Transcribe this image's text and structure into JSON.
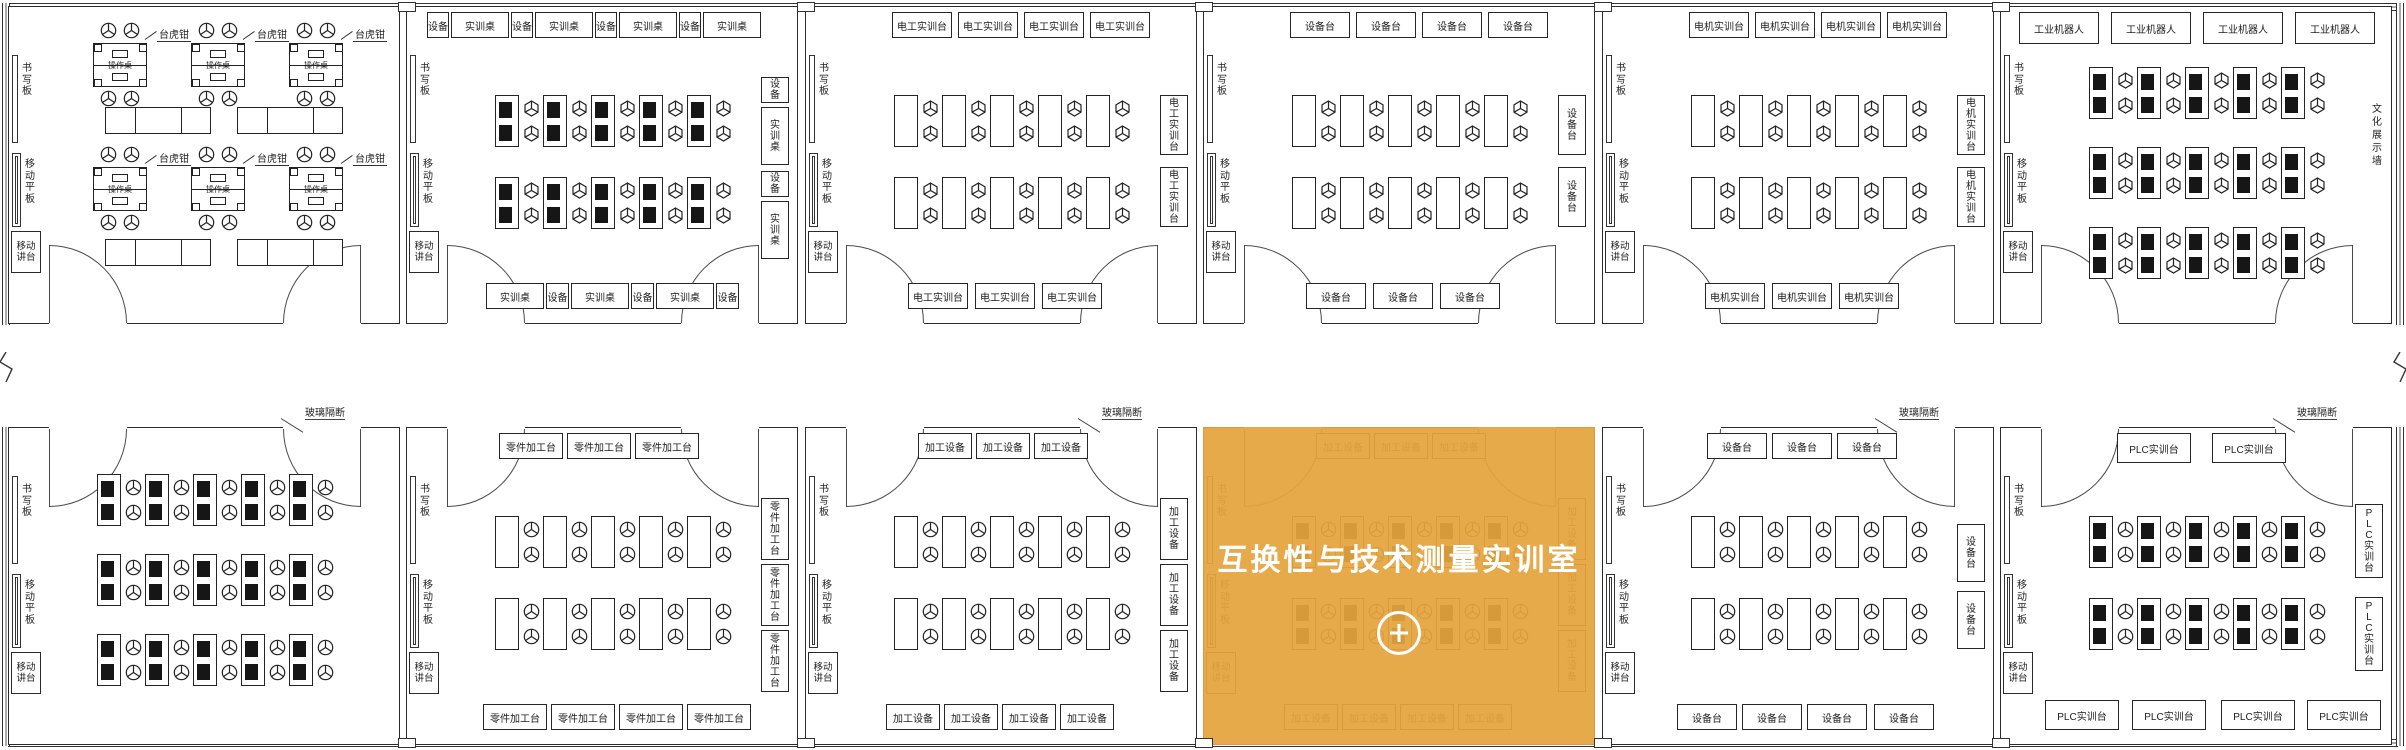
{
  "canvas": {
    "width": 2406,
    "height": 750
  },
  "palette": {
    "line": "#2b2b2b",
    "background": "#ffffff",
    "highlight_orange": "#e5a43e",
    "highlight_text": "#ffffff"
  },
  "highlight": {
    "title": "互换性与技术测量实训室",
    "icon": "plus-circle-icon",
    "room": "b4"
  },
  "shared_labels": {
    "writing_board": "书写板",
    "mobile_panel": "移动平板",
    "mobile_podium": "移动\n讲台",
    "glass_partition": "玻璃隔断",
    "culture_wall": "文化展示墙"
  },
  "rooms": [
    {
      "id": "t1",
      "name": "fitter-vise-room",
      "row": 0,
      "col": 0,
      "kind": "vise",
      "left_items": {
        "board": "书写板",
        "panel": "移动平板",
        "podium": "移动\n讲台"
      },
      "vise": {
        "callout": "台虎钳",
        "bench": "操作桌",
        "groups": 6,
        "cabinets": 4
      }
    },
    {
      "id": "t2",
      "name": "training-desk-room",
      "row": 0,
      "col": 1,
      "kind": "desks",
      "left_items": {
        "board": "书写板",
        "panel": "移动平板",
        "podium": "移动\n讲台"
      },
      "desks": {
        "rows": 2,
        "cols": 5,
        "style": "computer",
        "chair": "cube"
      },
      "top_boxes": [
        {
          "text": "设备",
          "x": 20,
          "w": 22
        },
        {
          "text": "实训桌",
          "x": 44,
          "w": 58
        },
        {
          "text": "设备",
          "x": 104,
          "w": 22
        },
        {
          "text": "实训桌",
          "x": 128,
          "w": 58
        },
        {
          "text": "设备",
          "x": 188,
          "w": 22
        },
        {
          "text": "实训桌",
          "x": 212,
          "w": 58
        },
        {
          "text": "设备",
          "x": 272,
          "w": 22
        },
        {
          "text": "实训桌",
          "x": 296,
          "w": 58
        }
      ],
      "bottom_boxes": [
        {
          "text": "实训桌",
          "x": 79,
          "w": 58
        },
        {
          "text": "设备",
          "x": 139,
          "w": 23
        },
        {
          "text": "实训桌",
          "x": 164,
          "w": 58
        },
        {
          "text": "设备",
          "x": 224,
          "w": 23
        },
        {
          "text": "实训桌",
          "x": 249,
          "w": 58
        },
        {
          "text": "设备",
          "x": 309,
          "w": 23
        }
      ],
      "right_boxes": [
        {
          "text": "设备",
          "y": 70,
          "h": 26
        },
        {
          "text": "实训桌",
          "y": 100,
          "h": 58
        },
        {
          "text": "设备",
          "y": 164,
          "h": 26
        },
        {
          "text": "实训桌",
          "y": 194,
          "h": 58
        }
      ]
    },
    {
      "id": "t3",
      "name": "electrician-training-room",
      "row": 0,
      "col": 2,
      "kind": "desks",
      "left_items": {
        "board": "书写板",
        "panel": "移动平板",
        "podium": "移动\n讲台"
      },
      "desks": {
        "rows": 2,
        "cols": 5,
        "style": "plain",
        "chair": "cube"
      },
      "top_boxes": [
        {
          "text": "电工实训台",
          "x": 86,
          "w": 60
        },
        {
          "text": "电工实训台",
          "x": 152,
          "w": 60
        },
        {
          "text": "电工实训台",
          "x": 218,
          "w": 60
        },
        {
          "text": "电工实训台",
          "x": 284,
          "w": 60
        }
      ],
      "bottom_boxes": [
        {
          "text": "电工实训台",
          "x": 102,
          "w": 60
        },
        {
          "text": "电工实训台",
          "x": 169,
          "w": 60
        },
        {
          "text": "电工实训台",
          "x": 236,
          "w": 60
        }
      ],
      "right_boxes": [
        {
          "text": "电工实训台",
          "y": 88,
          "h": 60
        },
        {
          "text": "电工实训台",
          "y": 160,
          "h": 60
        }
      ]
    },
    {
      "id": "t4",
      "name": "equipment-table-room-top",
      "row": 0,
      "col": 3,
      "kind": "desks",
      "left_items": {
        "board": "书写板",
        "panel": "移动平板",
        "podium": "移动\n讲台"
      },
      "desks": {
        "rows": 2,
        "cols": 5,
        "style": "plain",
        "chair": "cube"
      },
      "top_boxes": [
        {
          "text": "设备台",
          "x": 86,
          "w": 60
        },
        {
          "text": "设备台",
          "x": 152,
          "w": 60
        },
        {
          "text": "设备台",
          "x": 218,
          "w": 60
        },
        {
          "text": "设备台",
          "x": 284,
          "w": 60
        }
      ],
      "bottom_boxes": [
        {
          "text": "设备台",
          "x": 102,
          "w": 60
        },
        {
          "text": "设备台",
          "x": 169,
          "w": 60
        },
        {
          "text": "设备台",
          "x": 236,
          "w": 60
        }
      ],
      "right_boxes": [
        {
          "text": "设备台",
          "y": 88,
          "h": 60
        },
        {
          "text": "设备台",
          "y": 160,
          "h": 60
        }
      ]
    },
    {
      "id": "t5",
      "name": "motor-training-room",
      "row": 0,
      "col": 4,
      "kind": "desks",
      "left_items": {
        "board": "书写板",
        "panel": "移动平板",
        "podium": "移动\n讲台"
      },
      "desks": {
        "rows": 2,
        "cols": 5,
        "style": "plain",
        "chair": "cube"
      },
      "top_boxes": [
        {
          "text": "电机实训台",
          "x": 86,
          "w": 60
        },
        {
          "text": "电机实训台",
          "x": 152,
          "w": 60
        },
        {
          "text": "电机实训台",
          "x": 218,
          "w": 60
        },
        {
          "text": "电机实训台",
          "x": 284,
          "w": 60
        }
      ],
      "bottom_boxes": [
        {
          "text": "电机实训台",
          "x": 102,
          "w": 60
        },
        {
          "text": "电机实训台",
          "x": 169,
          "w": 60
        },
        {
          "text": "电机实训台",
          "x": 236,
          "w": 60
        }
      ],
      "right_boxes": [
        {
          "text": "电机实训台",
          "y": 88,
          "h": 60
        },
        {
          "text": "电机实训台",
          "y": 160,
          "h": 60
        }
      ]
    },
    {
      "id": "t6",
      "name": "industrial-robot-room",
      "row": 0,
      "col": 5,
      "kind": "desks",
      "left_items": {
        "board": "书写板",
        "panel": "移动平板",
        "podium": "移动\n讲台"
      },
      "desks": {
        "rows": 3,
        "cols": 5,
        "style": "computer",
        "chair": "cube"
      },
      "top_boxes": [
        {
          "text": "工业机器人",
          "x": 18,
          "w": 80,
          "h": 32
        },
        {
          "text": "工业机器人",
          "x": 110,
          "w": 80,
          "h": 32
        },
        {
          "text": "工业机器人",
          "x": 202,
          "w": 80,
          "h": 32
        },
        {
          "text": "工业机器人",
          "x": 294,
          "w": 80,
          "h": 32
        }
      ],
      "right_wall_label": "文化展示墙"
    },
    {
      "id": "b1",
      "name": "computer-training-room",
      "row": 1,
      "col": 0,
      "kind": "desks",
      "left_items": {
        "board": "书写板",
        "panel": "移动平板",
        "podium": "移动\n讲台"
      },
      "desks": {
        "rows": 3,
        "cols": 5,
        "style": "computer",
        "chair": "fan"
      },
      "glass_partition": "玻璃隔断"
    },
    {
      "id": "b2",
      "name": "parts-machining-room",
      "row": 1,
      "col": 1,
      "kind": "desks",
      "left_items": {
        "board": "书写板",
        "panel": "移动平板",
        "podium": "移动\n讲台"
      },
      "desks": {
        "rows": 2,
        "cols": 5,
        "style": "plain",
        "chair": "fan"
      },
      "top_boxes": [
        {
          "text": "零件加工台",
          "x": 92,
          "w": 64
        },
        {
          "text": "零件加工台",
          "x": 160,
          "w": 64
        },
        {
          "text": "零件加工台",
          "x": 228,
          "w": 64
        }
      ],
      "bottom_boxes": [
        {
          "text": "零件加工台",
          "x": 76,
          "w": 64
        },
        {
          "text": "零件加工台",
          "x": 144,
          "w": 64
        },
        {
          "text": "零件加工台",
          "x": 212,
          "w": 64
        },
        {
          "text": "零件加工台",
          "x": 280,
          "w": 64
        }
      ],
      "right_boxes": [
        {
          "text": "零件加工台",
          "y": 70,
          "h": 62
        },
        {
          "text": "零件加工台",
          "y": 136,
          "h": 62
        },
        {
          "text": "零件加工台",
          "y": 202,
          "h": 62
        }
      ]
    },
    {
      "id": "b3",
      "name": "machining-equipment-room",
      "row": 1,
      "col": 2,
      "kind": "desks",
      "left_items": {
        "board": "书写板",
        "panel": "移动平板",
        "podium": "移动\n讲台"
      },
      "desks": {
        "rows": 2,
        "cols": 5,
        "style": "plain",
        "chair": "fan"
      },
      "glass_partition": "玻璃隔断",
      "top_boxes": [
        {
          "text": "加工设备",
          "x": 112,
          "w": 54
        },
        {
          "text": "加工设备",
          "x": 170,
          "w": 54
        },
        {
          "text": "加工设备",
          "x": 228,
          "w": 54
        }
      ],
      "bottom_boxes": [
        {
          "text": "加工设备",
          "x": 80,
          "w": 54
        },
        {
          "text": "加工设备",
          "x": 138,
          "w": 54
        },
        {
          "text": "加工设备",
          "x": 196,
          "w": 54
        },
        {
          "text": "加工设备",
          "x": 254,
          "w": 54
        }
      ],
      "right_boxes": [
        {
          "text": "加工设备",
          "y": 70,
          "h": 62
        },
        {
          "text": "加工设备",
          "y": 136,
          "h": 62
        },
        {
          "text": "加工设备",
          "y": 202,
          "h": 62
        }
      ]
    },
    {
      "id": "b4",
      "name": "interchangeability-measurement-room",
      "row": 1,
      "col": 3,
      "kind": "desks",
      "highlighted": true,
      "left_items": {
        "board": "书写板",
        "panel": "移动平板",
        "podium": "移动\n讲台"
      },
      "desks": {
        "rows": 2,
        "cols": 5,
        "style": "computer",
        "chair": "fan"
      },
      "top_boxes": [
        {
          "text": "加工设备",
          "x": 112,
          "w": 54
        },
        {
          "text": "加工设备",
          "x": 170,
          "w": 54
        },
        {
          "text": "加工设备",
          "x": 228,
          "w": 54
        }
      ],
      "bottom_boxes": [
        {
          "text": "加工设备",
          "x": 80,
          "w": 54
        },
        {
          "text": "加工设备",
          "x": 138,
          "w": 54
        },
        {
          "text": "加工设备",
          "x": 196,
          "w": 54
        },
        {
          "text": "加工设备",
          "x": 254,
          "w": 54
        }
      ],
      "right_boxes": [
        {
          "text": "加工设备",
          "y": 70,
          "h": 62
        },
        {
          "text": "加工设备",
          "y": 136,
          "h": 62
        },
        {
          "text": "加工设备",
          "y": 202,
          "h": 62
        }
      ]
    },
    {
      "id": "b5",
      "name": "equipment-table-room-bottom",
      "row": 1,
      "col": 4,
      "kind": "desks",
      "left_items": {
        "board": "书写板",
        "panel": "移动平板",
        "podium": "移动\n讲台"
      },
      "desks": {
        "rows": 2,
        "cols": 5,
        "style": "plain",
        "chair": "fan"
      },
      "glass_partition": "玻璃隔断",
      "top_boxes": [
        {
          "text": "设备台",
          "x": 104,
          "w": 60
        },
        {
          "text": "设备台",
          "x": 169,
          "w": 60
        },
        {
          "text": "设备台",
          "x": 234,
          "w": 60
        }
      ],
      "bottom_boxes": [
        {
          "text": "设备台",
          "x": 74,
          "w": 60
        },
        {
          "text": "设备台",
          "x": 139,
          "w": 60
        },
        {
          "text": "设备台",
          "x": 204,
          "w": 60
        },
        {
          "text": "设备台",
          "x": 271,
          "w": 60
        }
      ],
      "right_boxes": [
        {
          "text": "设备台",
          "y": 96,
          "h": 58
        },
        {
          "text": "设备台",
          "y": 163,
          "h": 58
        }
      ]
    },
    {
      "id": "b6",
      "name": "plc-training-room",
      "row": 1,
      "col": 5,
      "kind": "desks",
      "left_items": {
        "board": "书写板",
        "panel": "移动平板",
        "podium": "移动\n讲台"
      },
      "desks": {
        "rows": 2,
        "cols": 5,
        "style": "computer",
        "chair": "fan"
      },
      "glass_partition": "玻璃隔断",
      "top_boxes": [
        {
          "text": "PLC实训台",
          "x": 116,
          "w": 74,
          "h": 30
        },
        {
          "text": "PLC实训台",
          "x": 211,
          "w": 74,
          "h": 30
        }
      ],
      "bottom_boxes": [
        {
          "text": "PLC实训台",
          "x": 44,
          "w": 74,
          "h": 30
        },
        {
          "text": "PLC实训台",
          "x": 131,
          "w": 74,
          "h": 30
        },
        {
          "text": "PLC实训台",
          "x": 220,
          "w": 74,
          "h": 30
        },
        {
          "text": "PLC实训台",
          "x": 306,
          "w": 74,
          "h": 30
        }
      ],
      "right_boxes": [
        {
          "text": "PLC实训台",
          "y": 76,
          "h": 74
        },
        {
          "text": "PLC实训台",
          "y": 169,
          "h": 74
        }
      ]
    }
  ]
}
